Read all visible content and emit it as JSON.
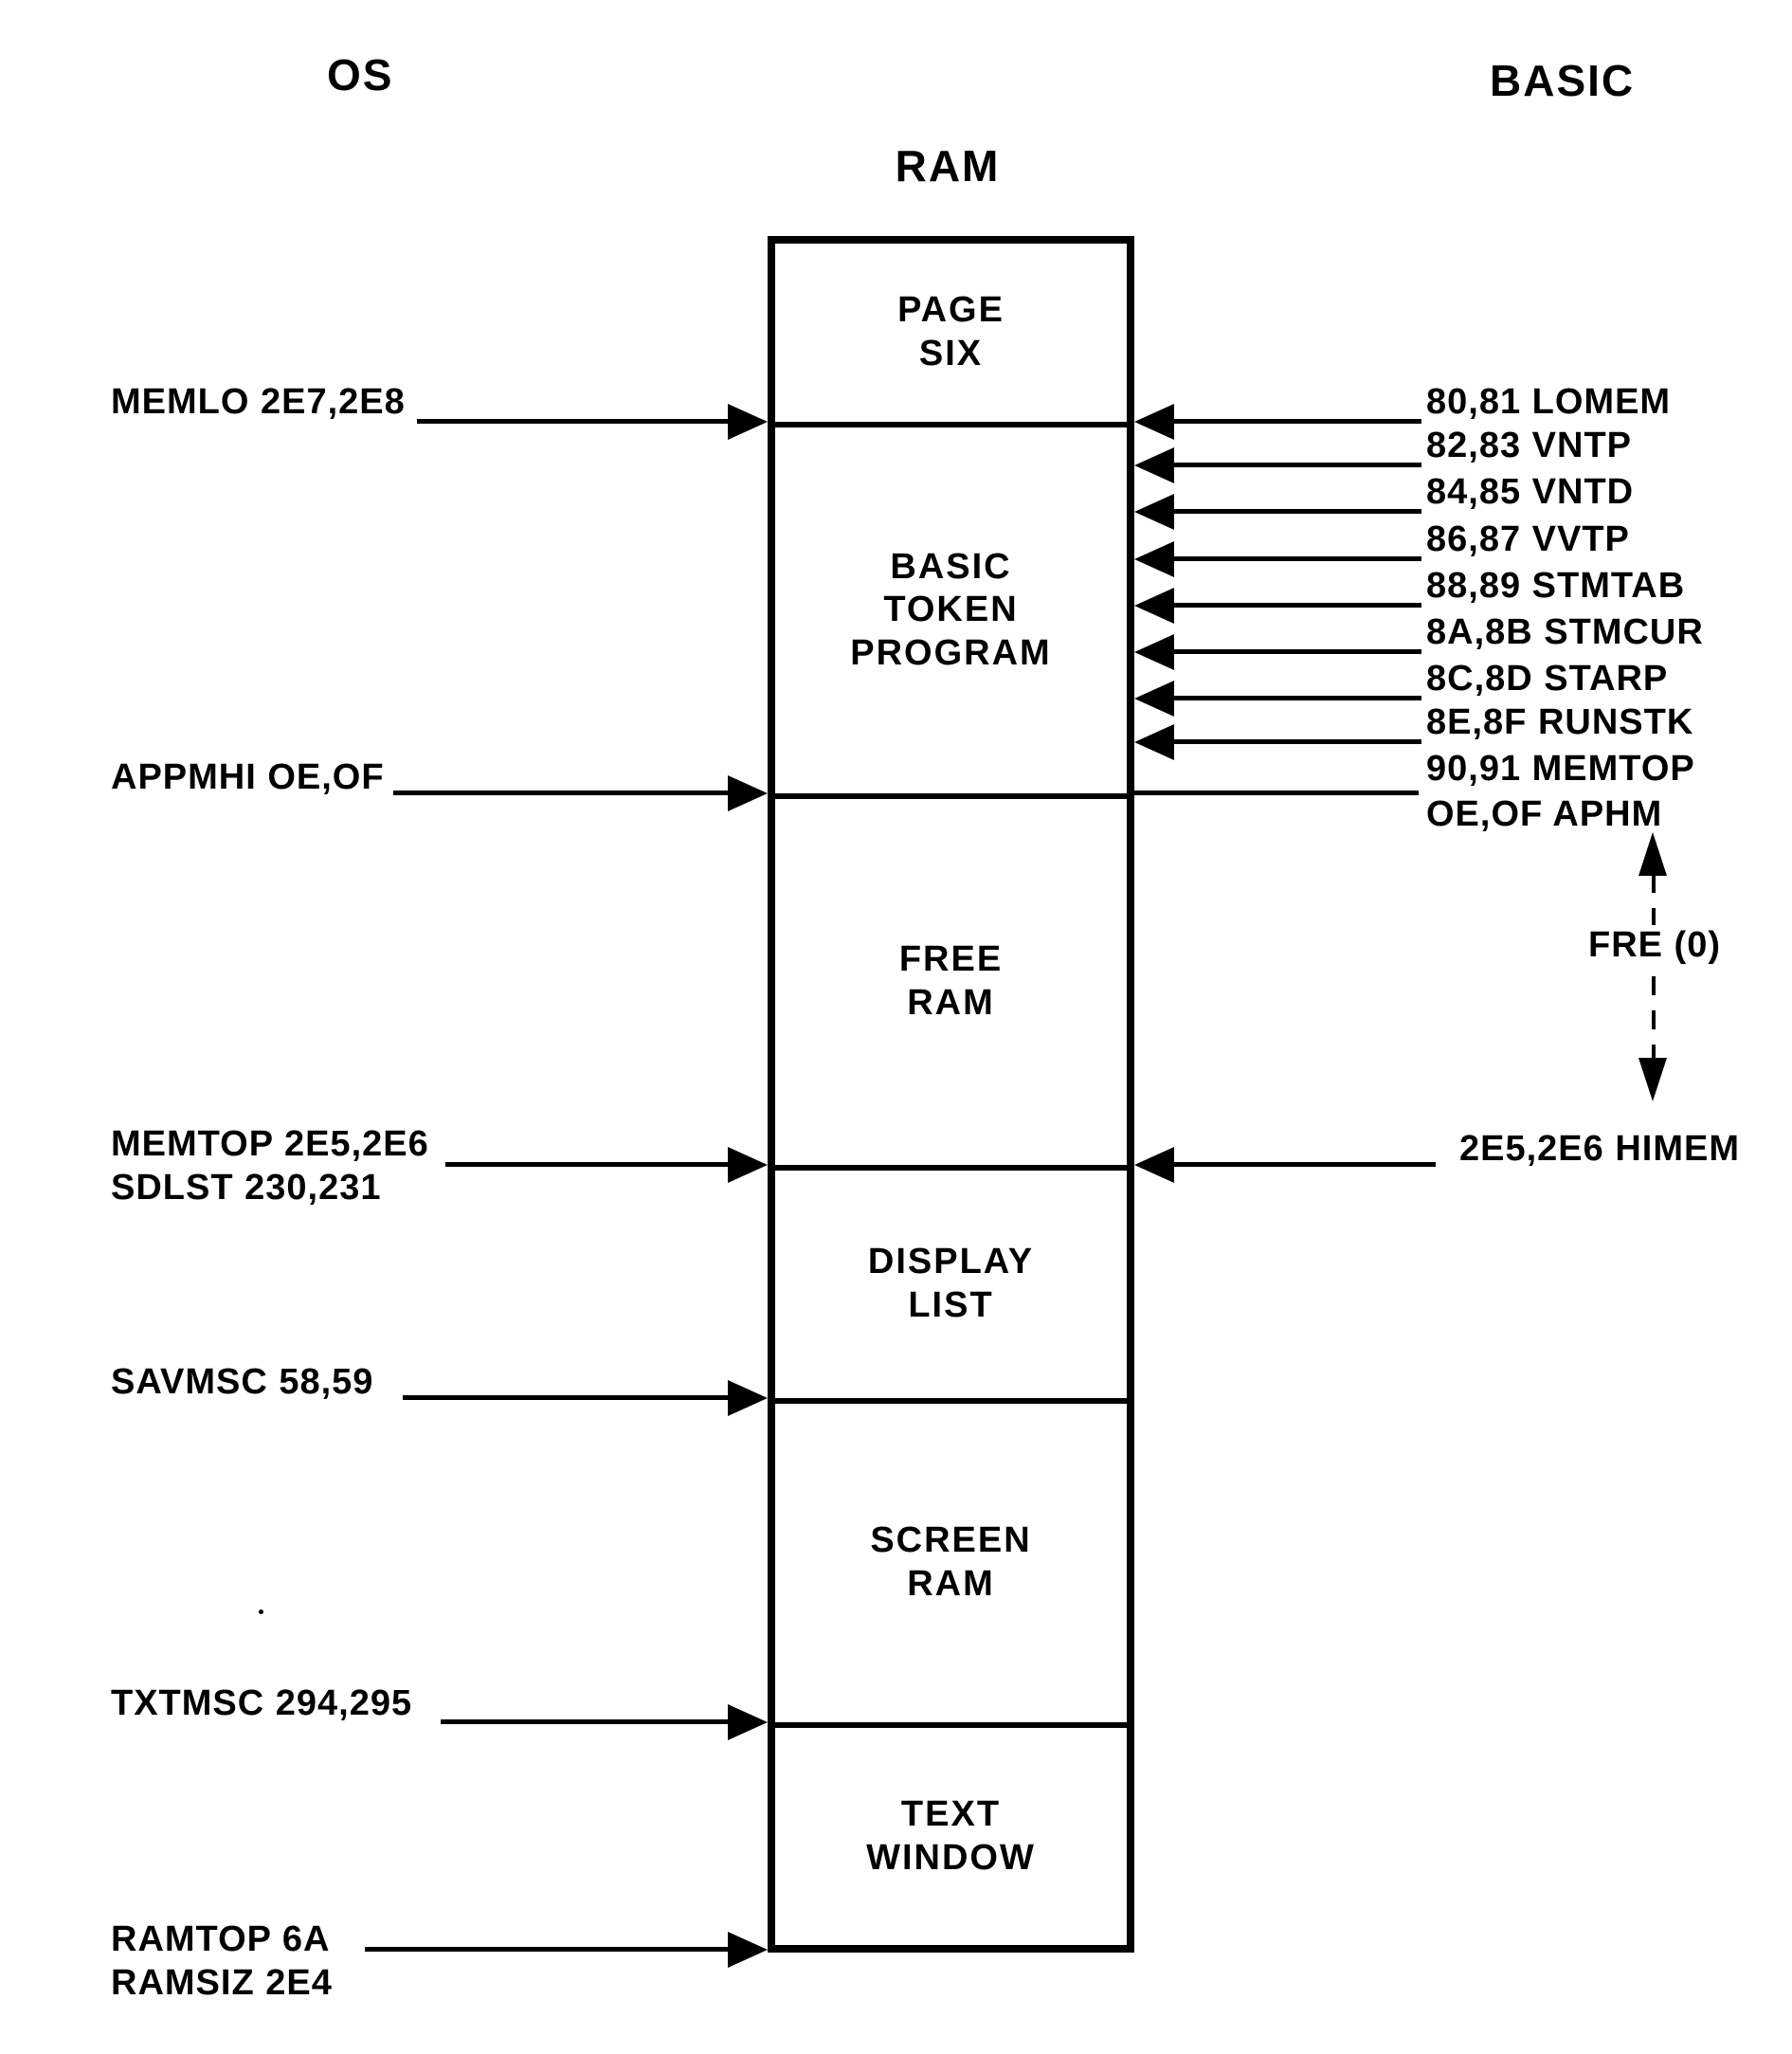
{
  "headers": {
    "os": "OS",
    "ram": "RAM",
    "basic": "BASIC"
  },
  "memory_box": {
    "sections": [
      {
        "label": "PAGE\nSIX"
      },
      {
        "label": "BASIC\nTOKEN\nPROGRAM"
      },
      {
        "label": "FREE\nRAM"
      },
      {
        "label": "DISPLAY\nLIST"
      },
      {
        "label": "SCREEN\nRAM"
      },
      {
        "label": "TEXT\nWINDOW"
      }
    ]
  },
  "os_pointers": [
    {
      "label": "MEMLO 2E7,2E8"
    },
    {
      "label": "APPMHI OE,OF"
    },
    {
      "label": "MEMTOP 2E5,2E6\nSDLST 230,231"
    },
    {
      "label": "SAVMSC 58,59"
    },
    {
      "label": "TXTMSC 294,295"
    },
    {
      "label": "RAMTOP 6A\nRAMSIZ 2E4"
    }
  ],
  "basic_pointers": [
    {
      "label": "80,81 LOMEM"
    },
    {
      "label": "82,83 VNTP"
    },
    {
      "label": "84,85 VNTD"
    },
    {
      "label": "86,87 VVTP"
    },
    {
      "label": "88,89 STMTAB"
    },
    {
      "label": "8A,8B STMCUR"
    },
    {
      "label": "8C,8D STARP"
    },
    {
      "label": "8E,8F RUNSTK"
    },
    {
      "label": "90,91 MEMTOP"
    },
    {
      "label": "OE,OF APHM"
    }
  ],
  "free_ram_span": {
    "label": "FRE (0)"
  },
  "himem_pointer": {
    "label": "2E5,2E6 HIMEM"
  }
}
